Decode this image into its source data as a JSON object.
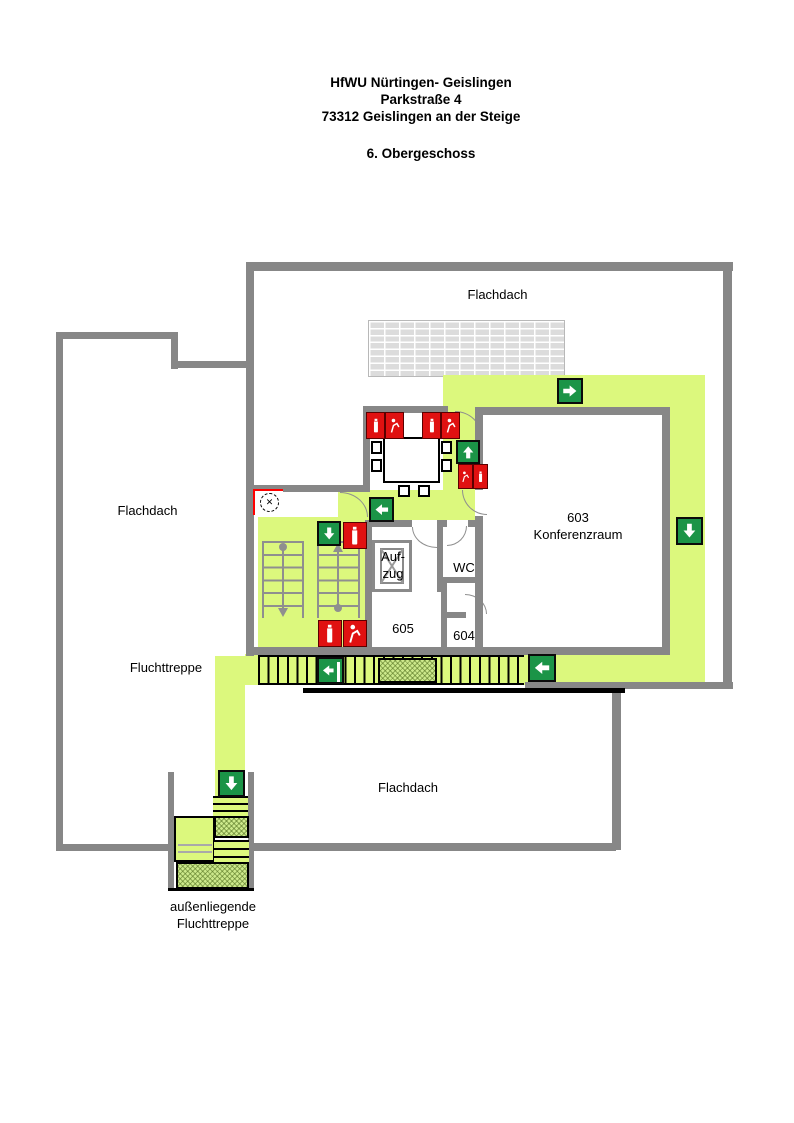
{
  "title": {
    "line1": "HfWU Nürtingen- Geislingen",
    "line2": "Parkstraße 4",
    "line3": "73312 Geislingen an der Steige",
    "floor": "6. Obergeschoss"
  },
  "labels": {
    "flachdach_top": "Flachdach",
    "flachdach_left": "Flachdach",
    "flachdach_bottom": "Flachdach",
    "fluchttreppe": "Fluchttreppe",
    "aussenliegende_1": "außenliegende",
    "aussenliegende_2": "Fluchttreppe",
    "room_603_1": "603",
    "room_603_2": "Konferenzraum",
    "room_604": "604",
    "room_605": "605",
    "wc": "WC",
    "aufzug_1": "Auf-",
    "aufzug_2": "zug"
  },
  "icons": {
    "location_marker": "✕"
  },
  "colors": {
    "wall_gray": "#878787",
    "escape_route_green": "#dcf87d",
    "exit_sign_green": "#1b9447",
    "fire_equipment_red": "#e01111",
    "hatch_green": "#cde98c",
    "skylight_gray": "#dcdcdc"
  },
  "signs": {
    "exit_directions": [
      "right",
      "up",
      "left",
      "down",
      "down",
      "left",
      "left",
      "down"
    ],
    "fire_extinguisher_points": 5
  },
  "rooms": [
    "603 Konferenzraum",
    "604",
    "605",
    "WC",
    "Aufzug"
  ]
}
